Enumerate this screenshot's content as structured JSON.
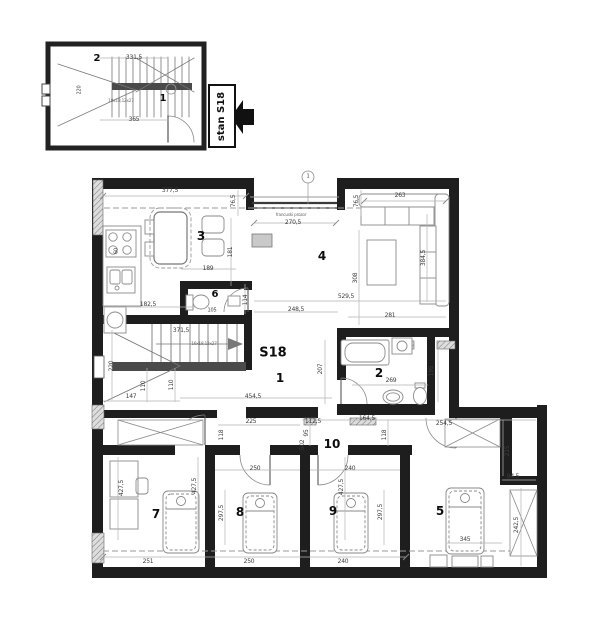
{
  "inset": {
    "rooms": [
      "2",
      "1"
    ],
    "dims": [
      "331,5",
      "365",
      "220"
    ],
    "stair_note": "19x18,12x27",
    "badge": "stan S18"
  },
  "main": {
    "unit": "S18",
    "rooms": [
      "1",
      "2",
      "3",
      "4",
      "5",
      "6",
      "7",
      "8",
      "9",
      "10"
    ],
    "dims": [
      "377,5",
      "76,5",
      "270,5",
      "263",
      "76,5",
      "181",
      "189",
      "384,5",
      "308",
      "529,5",
      "281",
      "248,5",
      "182,5",
      "105",
      "114",
      "371,5",
      "220",
      "110",
      "110",
      "147",
      "454,5",
      "269",
      "195",
      "207",
      "164,5",
      "112,5",
      "118",
      "95",
      "502",
      "225",
      "118",
      "254,5",
      "250",
      "240",
      "427,5",
      "427,5",
      "297,5",
      "427,5",
      "297,5",
      "215",
      "94,5",
      "242,5",
      "345",
      "251",
      "250",
      "240",
      "60",
      "16x18,12x27"
    ],
    "annotations": {
      "french_window": "francuski prozor",
      "ref_mark": "1"
    }
  },
  "colors": {
    "wall": "#1e1e1e",
    "furniture": "#8a8a8a",
    "dimline": "#b3b3b3",
    "tread_band": "#4a4a4a"
  }
}
